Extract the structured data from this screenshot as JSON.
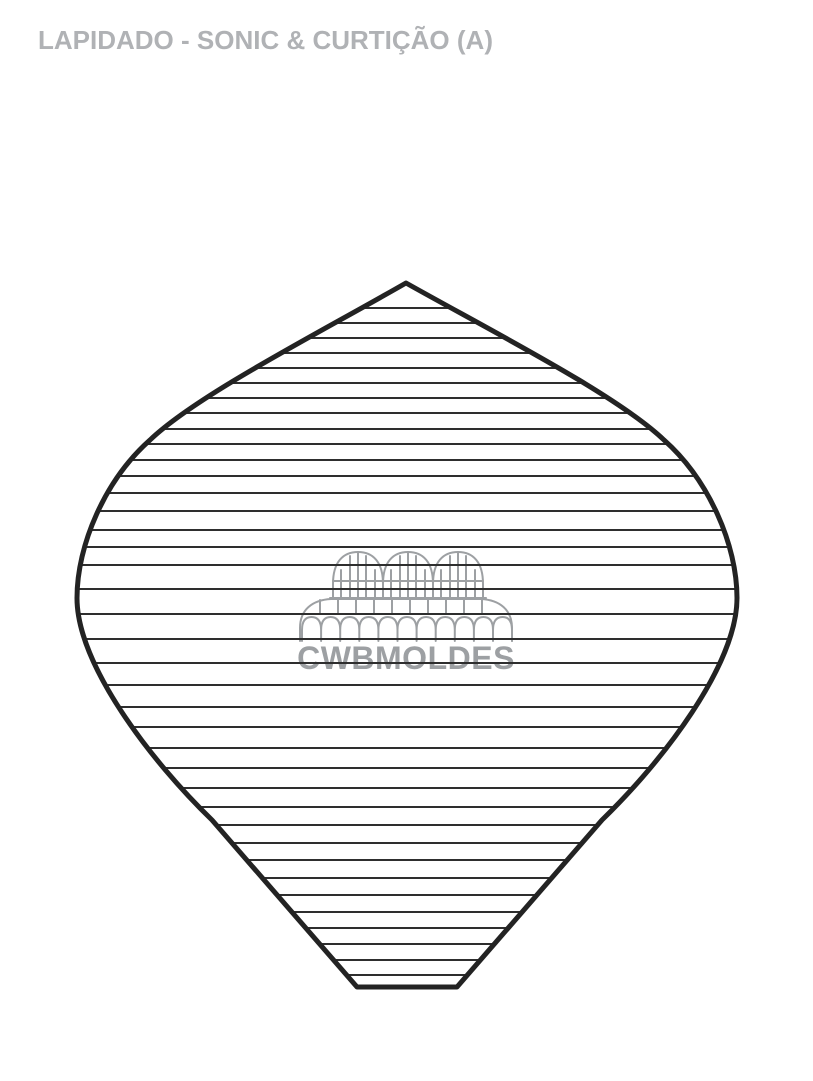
{
  "page": {
    "title": "LAPIDADO - SONIC & CURTIÇÃO (A)",
    "title_color": "#b0b2b5",
    "background_color": "#ffffff"
  },
  "watermark": {
    "brand": "CWBMOLDES",
    "icon": "greenhouse-icon",
    "color": "#9da0a3"
  },
  "shape": {
    "outline_color": "#232323",
    "outline_width": 5,
    "facet_line_color": "#2e2e2e",
    "facet_line_width": 2,
    "facet_line_x1": 70,
    "facet_line_x2": 745,
    "outline_path": "M 406 283 C 495 333 617 395 664 440 C 709 480 737 545 737 598 C 737 665 662 762 602 820 L 457 987 L 357 987 L 212 820 C 152 762 77 665 77 598 C 77 545 105 480 150 440 C 197 395 319 333 406 283 Z",
    "facet_line_ys": [
      308,
      323,
      338,
      353,
      368,
      383,
      398,
      413,
      429,
      444,
      460,
      476,
      493,
      511,
      530,
      547,
      565,
      589,
      614,
      639,
      663,
      685,
      707,
      727,
      748,
      768,
      788,
      807,
      825,
      843,
      860,
      878,
      895,
      912,
      928,
      944,
      960,
      975
    ]
  }
}
